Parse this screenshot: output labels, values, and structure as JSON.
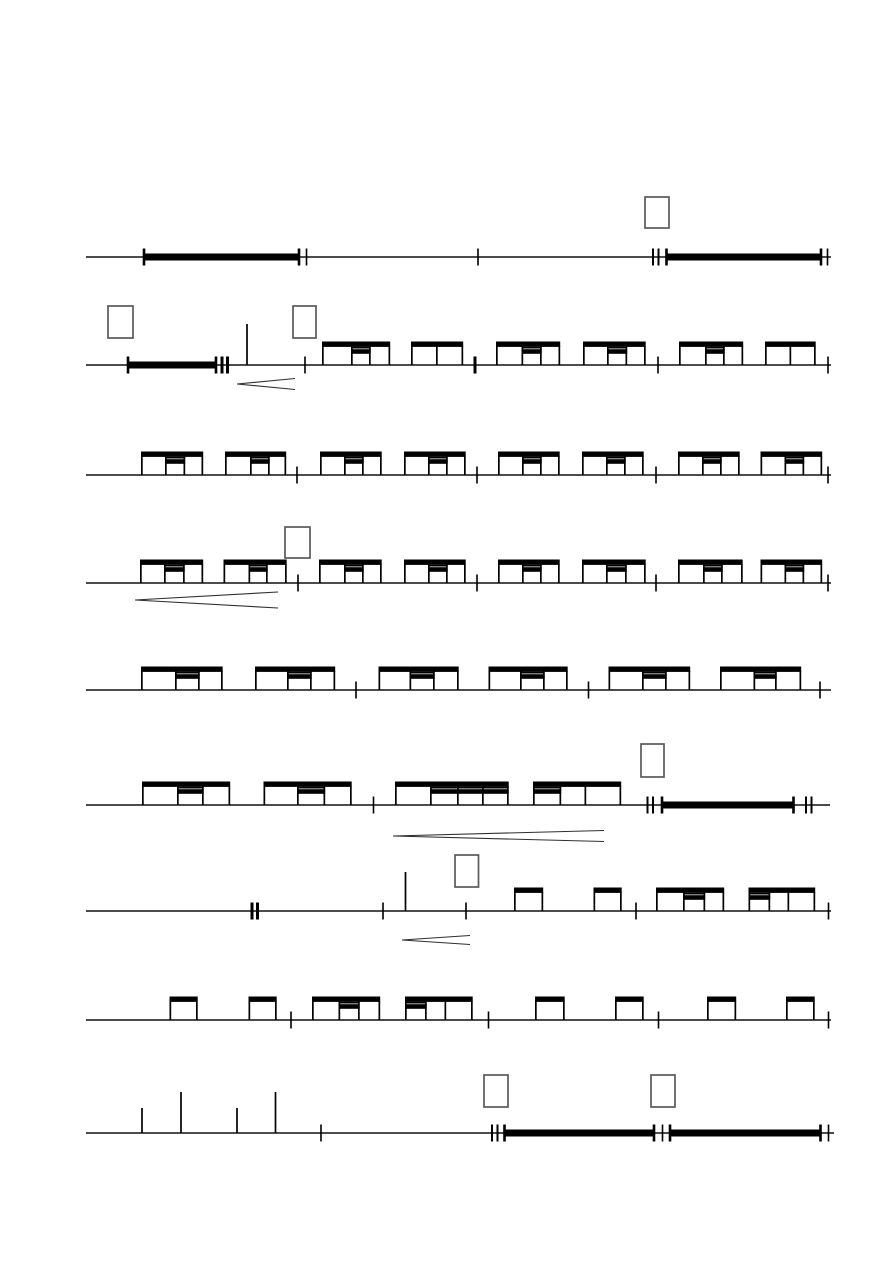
{
  "page": {
    "width": 893,
    "height": 1263,
    "background": "#ffffff",
    "ink": "#000000",
    "box_border": "#5a5a5a",
    "hairpin_color": "#2f2f2f"
  },
  "geometry": {
    "staff_stroke": 1.4,
    "beam_rise": 23.5,
    "beam_thick": 5.4,
    "sec_line_thick": 1.6,
    "sec_bar_offset": 15.8,
    "sec_bar_thick": 4.6,
    "stem_w": 1.7,
    "bar_thick": 7,
    "bar_tick_w": 2.6,
    "tick_h": 17,
    "tick_w": 1.6,
    "bold_w": 3,
    "dtick_gap": 5.5,
    "dtick_w": 2,
    "box_stroke": 1.7,
    "hairpin_stroke": 1.1
  },
  "score": {
    "line_x_start": 86,
    "line_x_end": 831,
    "systems": [
      {
        "y": 257,
        "elements": [
          {
            "type": "box",
            "x": 645,
            "y": 197,
            "w": 24,
            "h": 31
          },
          {
            "type": "bar",
            "x1": 144,
            "x2": 299
          },
          {
            "type": "tick",
            "x": 306.5
          },
          {
            "type": "barline",
            "x": 478
          },
          {
            "type": "dtick",
            "x": 653
          },
          {
            "type": "bar",
            "x1": 666.5,
            "x2": 821
          },
          {
            "type": "tick",
            "x": 827.5
          }
        ]
      },
      {
        "y": 365,
        "elements": [
          {
            "type": "box",
            "x": 108,
            "y": 306,
            "w": 25,
            "h": 32
          },
          {
            "type": "box",
            "x": 293,
            "y": 306,
            "w": 23,
            "h": 32
          },
          {
            "type": "bar",
            "x1": 128,
            "x2": 216
          },
          {
            "type": "dtick",
            "x": 222,
            "bold": true
          },
          {
            "type": "stem",
            "x": 247,
            "h": 41
          },
          {
            "type": "barline",
            "x": 305
          },
          {
            "type": "group",
            "stems": [
              322,
              351,
              369,
              388.5
            ],
            "sec": [
              351,
              369
            ]
          },
          {
            "type": "group",
            "stems": [
              411,
              436,
              461.5
            ]
          },
          {
            "type": "barline",
            "x": 475,
            "bold": true
          },
          {
            "type": "group",
            "stems": [
              496,
              521.5,
              540,
              558.5
            ],
            "sec": [
              521.5,
              540
            ]
          },
          {
            "type": "group",
            "stems": [
              583,
              607,
              625.5,
              644
            ],
            "sec": [
              607,
              625.5
            ]
          },
          {
            "type": "barline",
            "x": 658
          },
          {
            "type": "group",
            "stems": [
              679,
              705,
              723,
              741.5
            ],
            "sec": [
              705,
              723
            ]
          },
          {
            "type": "group",
            "stems": [
              765,
              789.5,
              814
            ]
          },
          {
            "type": "tick",
            "x": 828
          },
          {
            "type": "hairpin",
            "x1": 237,
            "y": 384,
            "x2": 295,
            "spread": 5.5
          }
        ]
      },
      {
        "y": 475,
        "elements": [
          {
            "type": "group",
            "stems": [
              141,
              165,
              183.5,
              201.5
            ],
            "sec": [
              165,
              183.5
            ]
          },
          {
            "type": "group",
            "stems": [
              225,
              250,
              268,
              284.5
            ],
            "sec": [
              250,
              268
            ]
          },
          {
            "type": "barline",
            "x": 297
          },
          {
            "type": "group",
            "stems": [
              320,
              344,
              362,
              380
            ],
            "sec": [
              344,
              362
            ]
          },
          {
            "type": "group",
            "stems": [
              404,
              428,
              446,
              464
            ],
            "sec": [
              428,
              446
            ]
          },
          {
            "type": "barline",
            "x": 477
          },
          {
            "type": "group",
            "stems": [
              498,
              522,
              540,
              558
            ],
            "sec": [
              522,
              540
            ]
          },
          {
            "type": "group",
            "stems": [
              582,
              606,
              624,
              642
            ],
            "sec": [
              606,
              624
            ]
          },
          {
            "type": "barline",
            "x": 656
          },
          {
            "type": "group",
            "stems": [
              678,
              702,
              720,
              738
            ],
            "sec": [
              702,
              720
            ]
          },
          {
            "type": "group",
            "stems": [
              760.5,
              784.5,
              802.5,
              820.5
            ],
            "sec": [
              784.5,
              802.5
            ]
          },
          {
            "type": "tick",
            "x": 828
          }
        ]
      },
      {
        "y": 583,
        "elements": [
          {
            "type": "box",
            "x": 285,
            "y": 527,
            "w": 25,
            "h": 31
          },
          {
            "type": "group",
            "stems": [
              140,
              164,
              183,
              201.5
            ],
            "sec": [
              164,
              183
            ]
          },
          {
            "type": "group",
            "stems": [
              223.5,
              248.5,
              266,
              285
            ],
            "sec": [
              248.5,
              266
            ]
          },
          {
            "type": "barline",
            "x": 298
          },
          {
            "type": "group",
            "stems": [
              319,
              344,
              362,
              380
            ],
            "sec": [
              344,
              362
            ]
          },
          {
            "type": "group",
            "stems": [
              404,
              428,
              446,
              464
            ],
            "sec": [
              428,
              446
            ]
          },
          {
            "type": "barline",
            "x": 477
          },
          {
            "type": "group",
            "stems": [
              498,
              522,
              540,
              558
            ],
            "sec": [
              522,
              540
            ]
          },
          {
            "type": "group",
            "stems": [
              582,
              606,
              625,
              644
            ],
            "sec": [
              606,
              625
            ]
          },
          {
            "type": "barline",
            "x": 656
          },
          {
            "type": "group",
            "stems": [
              678,
              703,
              721,
              741
            ],
            "sec": [
              703,
              721
            ]
          },
          {
            "type": "group",
            "stems": [
              760.5,
              784.5,
              802.5,
              820.5
            ],
            "sec": [
              784.5,
              802.5
            ]
          },
          {
            "type": "tick",
            "x": 828
          },
          {
            "type": "hairpin",
            "x1": 135,
            "y": 600,
            "x2": 278,
            "spread": 8
          }
        ]
      },
      {
        "y": 690,
        "elements": [
          {
            "type": "group",
            "stems": [
              141,
              175,
              198,
              221
            ],
            "sec": [
              175,
              198
            ]
          },
          {
            "type": "group",
            "stems": [
              255,
              287,
              310,
              333.5
            ],
            "sec": [
              287,
              310
            ]
          },
          {
            "type": "barline",
            "x": 356
          },
          {
            "type": "group",
            "stems": [
              378.5,
              409.5,
              433,
              457
            ],
            "sec": [
              409.5,
              433
            ]
          },
          {
            "type": "group",
            "stems": [
              488.5,
              520,
              543,
              566
            ],
            "sec": [
              520,
              543
            ]
          },
          {
            "type": "barline",
            "x": 588.5
          },
          {
            "type": "group",
            "stems": [
              608.5,
              642,
              665,
              688.5
            ],
            "sec": [
              642,
              665
            ]
          },
          {
            "type": "group",
            "stems": [
              720,
              753.5,
              775,
              799.5
            ],
            "sec": [
              753.5,
              775
            ]
          },
          {
            "type": "tick",
            "x": 820
          }
        ]
      },
      {
        "y": 805,
        "x_end": 830,
        "elements": [
          {
            "type": "box",
            "x": 641,
            "y": 744,
            "w": 23,
            "h": 33
          },
          {
            "type": "group",
            "stems": [
              142,
              177,
              202,
              228.5
            ],
            "sec": [
              177,
              202
            ]
          },
          {
            "type": "group",
            "stems": [
              263.5,
              297,
              323.5,
              350
            ],
            "sec": [
              297,
              323.5
            ]
          },
          {
            "type": "barline",
            "x": 373.5
          },
          {
            "type": "group",
            "stems": [
              395,
              430,
              457,
              482,
              507
            ],
            "sec": [
              430,
              507
            ]
          },
          {
            "type": "group",
            "stems": [
              533,
              559.5,
              584.5,
              619.5
            ],
            "sec": [
              533,
              559.5
            ]
          },
          {
            "type": "dtick",
            "x": 647.5
          },
          {
            "type": "bar",
            "x1": 662,
            "x2": 793.5
          },
          {
            "type": "dtick",
            "x": 806
          },
          {
            "type": "hairpin",
            "x1": 393,
            "y": 836,
            "x2": 604,
            "spread": 5.5
          }
        ]
      },
      {
        "y": 911,
        "elements": [
          {
            "type": "box",
            "x": 455,
            "y": 855,
            "w": 23.5,
            "h": 32
          },
          {
            "type": "dtick",
            "x": 252,
            "bold": true
          },
          {
            "type": "barline",
            "x": 383
          },
          {
            "type": "stem",
            "x": 405.5,
            "h": 39
          },
          {
            "type": "barline",
            "x": 466
          },
          {
            "type": "group",
            "stems": [
              514,
              541.5
            ]
          },
          {
            "type": "group",
            "stems": [
              593.5,
              620
            ]
          },
          {
            "type": "barline",
            "x": 636
          },
          {
            "type": "group",
            "stems": [
              656,
              683,
              703.5,
              722.5
            ],
            "sec": [
              683,
              703.5
            ]
          },
          {
            "type": "group",
            "stems": [
              748.5,
              768.5,
              787.5,
              813.5
            ],
            "sec": [
              748.5,
              768.5
            ]
          },
          {
            "type": "tick",
            "x": 828.5
          },
          {
            "type": "hairpin",
            "x1": 402,
            "y": 940,
            "x2": 470,
            "spread": 4.5
          }
        ]
      },
      {
        "y": 1020,
        "elements": [
          {
            "type": "group",
            "stems": [
              169.5,
              196
            ]
          },
          {
            "type": "group",
            "stems": [
              248.5,
              275
            ]
          },
          {
            "type": "barline",
            "x": 291
          },
          {
            "type": "group",
            "stems": [
              312,
              338.5,
              358,
              378.5
            ],
            "sec": [
              338.5,
              358
            ]
          },
          {
            "type": "group",
            "stems": [
              405,
              425,
              444.5,
              471
            ],
            "sec": [
              405,
              425
            ]
          },
          {
            "type": "barline",
            "x": 488.5
          },
          {
            "type": "group",
            "stems": [
              535,
              563
            ]
          },
          {
            "type": "group",
            "stems": [
              615,
              642
            ]
          },
          {
            "type": "barline",
            "x": 658.5
          },
          {
            "type": "group",
            "stems": [
              707,
              734.5
            ]
          },
          {
            "type": "group",
            "stems": [
              786,
              813
            ]
          },
          {
            "type": "tick",
            "x": 828.5
          }
        ]
      },
      {
        "y": 1133,
        "x_end": 834,
        "elements": [
          {
            "type": "box",
            "x": 484,
            "y": 1075,
            "w": 24,
            "h": 32
          },
          {
            "type": "box",
            "x": 651,
            "y": 1075,
            "w": 24,
            "h": 32
          },
          {
            "type": "stem",
            "x": 142,
            "h": 25
          },
          {
            "type": "stem",
            "x": 181,
            "h": 41
          },
          {
            "type": "stem",
            "x": 237,
            "h": 25
          },
          {
            "type": "stem",
            "x": 275.5,
            "h": 41
          },
          {
            "type": "barline",
            "x": 321
          },
          {
            "type": "dtick",
            "x": 492
          },
          {
            "type": "bar",
            "x1": 504.5,
            "x2": 654
          },
          {
            "type": "tick",
            "x": 662.5
          },
          {
            "type": "bar",
            "x1": 670,
            "x2": 820.5
          },
          {
            "type": "tick",
            "x": 828.5
          }
        ]
      }
    ]
  }
}
